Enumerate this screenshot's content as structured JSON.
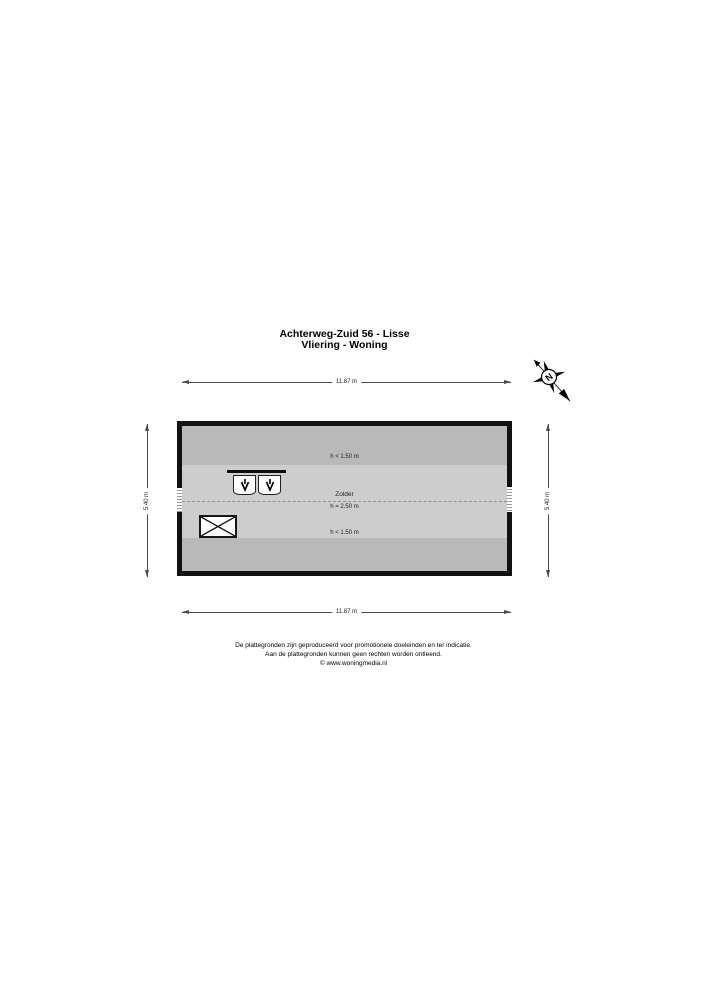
{
  "header": {
    "address": "Achterweg-Zuid 56 - Lisse",
    "floor": "Vliering - Woning"
  },
  "compass": {
    "north_label": "N"
  },
  "plan": {
    "room": {
      "name": "Zolder",
      "ceiling_height": "h = 2.50 m"
    },
    "low_headroom_top": "h < 1.50 m",
    "low_headroom_bottom": "h < 1.50 m",
    "dimensions": {
      "top": "11.87 m",
      "bottom": "11.87 m",
      "left": "5.40 m",
      "right": "5.40 m"
    }
  },
  "footer": {
    "line1": "De plattegronden zijn geproduceerd voor promotionele doeleinden en ter indicatie.",
    "line2": "Aan de plattegronden kunnen geen rechten worden ontleend.",
    "line3": "© www.woningmedia.nl"
  },
  "colors": {
    "wall": "#111111",
    "floor_main": "#cdcdcd",
    "floor_low_headroom": "#b9b9b9",
    "background": "#ffffff"
  },
  "icons": {
    "north_compass": "north-arrow-rose",
    "roof_window_arrow": "↓",
    "stair_void_cross": "✕"
  }
}
